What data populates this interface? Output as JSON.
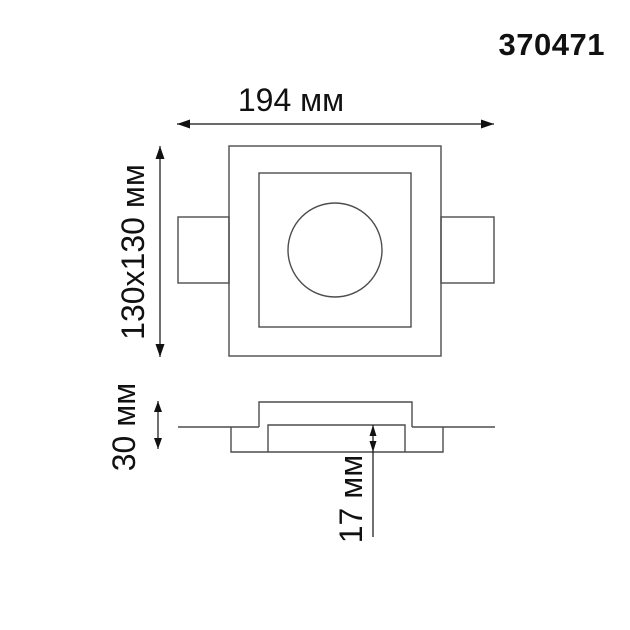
{
  "article": "370471",
  "labels": {
    "width": "194 мм",
    "face": "130x130 мм",
    "height": "30 мм",
    "depth": "17 мм"
  },
  "colors": {
    "background": "#ffffff",
    "outline": "#4d4d4d",
    "dimension": "#111111"
  },
  "drawing": {
    "type": "technical-dimension-drawing",
    "views": [
      "top-view",
      "section-view"
    ],
    "dimensions_mm": {
      "overall_width": 194,
      "face_plate": "130x130",
      "total_height": 30,
      "recess_depth": 17
    }
  }
}
